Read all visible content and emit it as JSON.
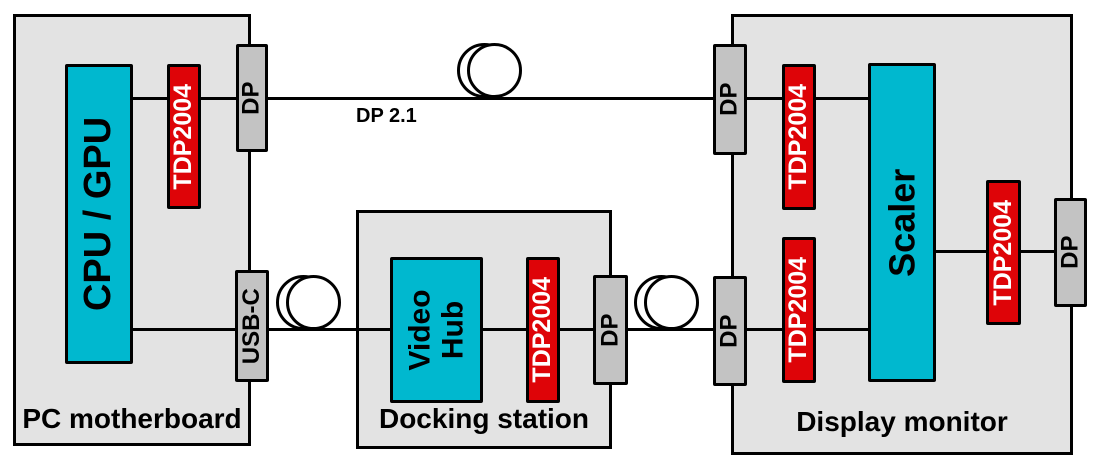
{
  "diagram_title": "TDP2004 DP 2.1 signal chain block diagram",
  "colors": {
    "background": "#ffffff",
    "block_fill": "#e3e3e3",
    "connector_fill": "#c3c3c3",
    "redriver_fill": "#de0408",
    "ic_fill": "#00b8cf",
    "line": "#000000",
    "redriver_text": "#ffffff",
    "text": "#000000"
  },
  "blocks": {
    "pc": {
      "label": "PC motherboard"
    },
    "dock": {
      "label": "Docking station"
    },
    "monitor": {
      "label": "Display monitor"
    }
  },
  "chips": {
    "cpu_gpu": {
      "label": "CPU / GPU"
    },
    "video_hub": {
      "line1": "Video",
      "line2": "Hub"
    },
    "scaler": {
      "label": "Scaler"
    },
    "redriver": {
      "label": "TDP2004"
    }
  },
  "connectors": {
    "dp": {
      "label": "DP"
    },
    "usb_c": {
      "label": "USB-C"
    }
  },
  "links": {
    "dp21": {
      "label": "DP 2.1"
    }
  }
}
